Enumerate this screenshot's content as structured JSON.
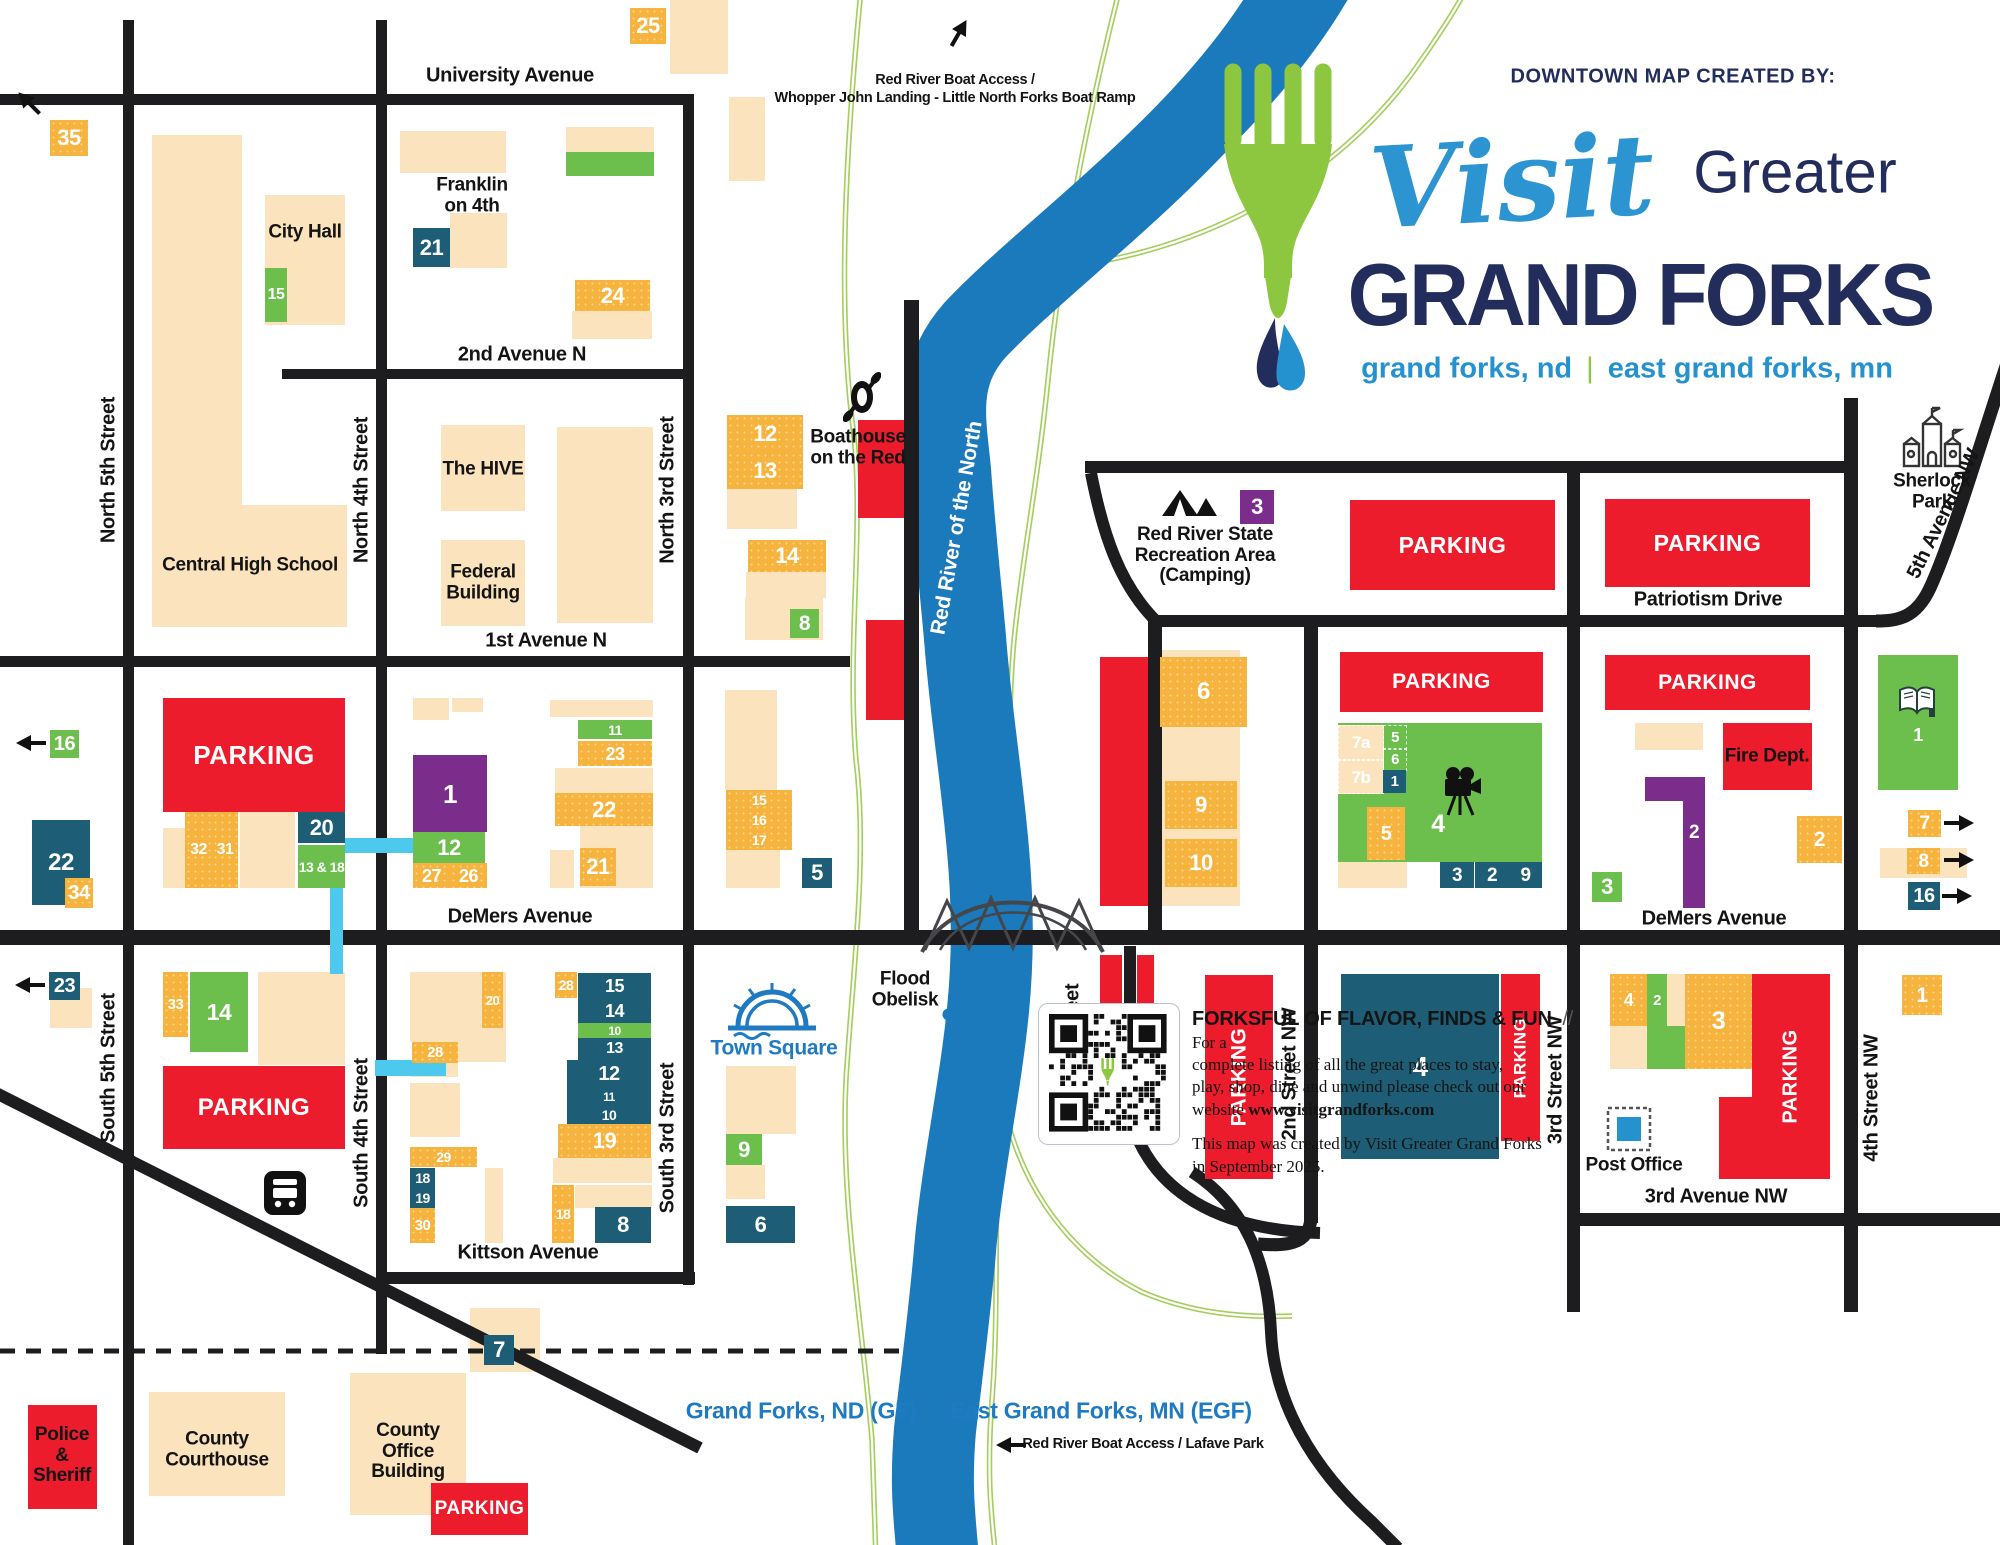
{
  "map": {
    "colors": {
      "river": "#1b7abc",
      "road": "#1d1d1f",
      "parking_red": "#ec1c2d",
      "orange": "#f6b33d",
      "green": "#6cbf4c",
      "teal": "#1d5d75",
      "purple": "#7b2d8b",
      "building": "#fbe4bd",
      "trail": "#a6ce5e",
      "skywalk": "#4ec9ee",
      "navy": "#232d5c",
      "blue": "#2492cf",
      "lime": "#8dc63f"
    },
    "logo": {
      "created_by": "DOWNTOWN MAP CREATED BY:",
      "visit": "Visit",
      "greater": "Greater",
      "grand_forks": "GRAND FORKS",
      "sub_left": "grand forks, nd",
      "sub_divider": "|",
      "sub_right": "east grand forks, mn"
    },
    "credits": {
      "heading": "FORKSFUL OF  FLAVOR, FINDS & FUN",
      "separator": "//",
      "lead": "For a",
      "body1": "complete listing of all the great places to stay,",
      "body2": "play, shop, dine and unwind please check out our",
      "body3_pre": "website ",
      "body3_bold": "www.visitgrandforks.com",
      "note1": "This map was created by Visit Greater Grand Forks",
      "note2": "in September 2025."
    },
    "parking_label": "PARKING",
    "city_labels": [
      {
        "t": "Grand Forks, ND (GF)",
        "x": 801,
        "y": 1411
      },
      {
        "t": "East Grand Forks, MN (EGF)",
        "x": 1101,
        "y": 1411
      }
    ],
    "annotations": [
      {
        "t": "Red River Boat Access /\nWhopper John Landing - Little North Forks Boat Ramp",
        "x": 955,
        "y": 89
      },
      {
        "t": "Red River Boat Access / Lafave Park",
        "x": 1143,
        "y": 1444
      }
    ],
    "streets": [
      {
        "t": "University Avenue",
        "x": 510,
        "y": 76,
        "r": 0
      },
      {
        "t": "2nd Avenue N",
        "x": 522,
        "y": 355,
        "r": 0
      },
      {
        "t": "1st Avenue N",
        "x": 546,
        "y": 641,
        "r": 0
      },
      {
        "t": "DeMers Avenue",
        "x": 520,
        "y": 917,
        "r": 0
      },
      {
        "t": "Kittson Avenue",
        "x": 528,
        "y": 1253,
        "r": 0
      },
      {
        "t": "DeMers Avenue",
        "x": 1714,
        "y": 919,
        "r": 0
      },
      {
        "t": "Patriotism Drive",
        "x": 1708,
        "y": 600,
        "r": 0
      },
      {
        "t": "3rd Avenue NW",
        "x": 1716,
        "y": 1197,
        "r": 0
      },
      {
        "t": "North 5th Street",
        "x": 109,
        "y": 470,
        "r": -90
      },
      {
        "t": "South 5th Street",
        "x": 109,
        "y": 1068,
        "r": -90
      },
      {
        "t": "North 4th Street",
        "x": 362,
        "y": 490,
        "r": -90
      },
      {
        "t": "South 4th Street",
        "x": 362,
        "y": 1133,
        "r": -90
      },
      {
        "t": "North 3rd Street",
        "x": 668,
        "y": 490,
        "r": -90
      },
      {
        "t": "South 3rd Street",
        "x": 668,
        "y": 1138,
        "r": -90
      },
      {
        "t": "River Street",
        "x": 1073,
        "y": 1038,
        "r": -90
      },
      {
        "t": "2nd Street NW",
        "x": 1290,
        "y": 1074,
        "r": -90
      },
      {
        "t": "3rd Street NW",
        "x": 1556,
        "y": 1080,
        "r": -90
      },
      {
        "t": "4th Street NW",
        "x": 1872,
        "y": 1098,
        "r": -90
      },
      {
        "t": "5th Avenue NW",
        "x": 1944,
        "y": 514,
        "r": -64
      },
      {
        "t": "Red River of the North",
        "x": 957,
        "y": 528,
        "r": -80,
        "river": true
      }
    ],
    "landmarks": [
      {
        "t": "City Hall",
        "x": 305,
        "y": 233
      },
      {
        "t": "Franklin\non 4th",
        "x": 472,
        "y": 196
      },
      {
        "t": "Central High School",
        "x": 250,
        "y": 566
      },
      {
        "t": "The HIVE",
        "x": 483,
        "y": 470
      },
      {
        "t": "Federal\nBuilding",
        "x": 483,
        "y": 583
      },
      {
        "t": "Boathouse\non the Red",
        "x": 858,
        "y": 448
      },
      {
        "t": "Red River State\nRecreation Area\n(Camping)",
        "x": 1205,
        "y": 556
      },
      {
        "t": "Sherlock\nPark",
        "x": 1932,
        "y": 492
      },
      {
        "t": "Fire Dept.",
        "x": 1767,
        "y": 757
      },
      {
        "t": "Town Square",
        "x": 774,
        "y": 1049,
        "cls": "blue"
      },
      {
        "t": "Flood\nObelisk",
        "x": 905,
        "y": 990
      },
      {
        "t": "Post Office",
        "x": 1634,
        "y": 1166
      },
      {
        "t": "County\nCourthouse",
        "x": 217,
        "y": 1450
      },
      {
        "t": "County\nOffice\nBuilding",
        "x": 408,
        "y": 1452
      },
      {
        "t": "Police\n&\nSheriff",
        "x": 62,
        "y": 1456
      }
    ],
    "parking_lots": [
      {
        "x": 163,
        "y": 698,
        "w": 182,
        "h": 114,
        "v": false,
        "fs": 26
      },
      {
        "x": 163,
        "y": 1066,
        "w": 182,
        "h": 83,
        "v": false,
        "fs": 24
      },
      {
        "x": 1350,
        "y": 500,
        "w": 205,
        "h": 90,
        "v": false,
        "fs": 23
      },
      {
        "x": 1605,
        "y": 499,
        "w": 205,
        "h": 88,
        "v": false,
        "fs": 23
      },
      {
        "x": 1340,
        "y": 652,
        "w": 203,
        "h": 60,
        "v": false,
        "fs": 21
      },
      {
        "x": 1605,
        "y": 655,
        "w": 205,
        "h": 55,
        "v": false,
        "fs": 21
      },
      {
        "x": 1205,
        "y": 975,
        "w": 68,
        "h": 204,
        "v": true,
        "fs": 21
      },
      {
        "x": 1501,
        "y": 974,
        "w": 39,
        "h": 167,
        "v": true,
        "fs": 17
      },
      {
        "x": 1752,
        "y": 974,
        "w": 78,
        "h": 205,
        "v": true,
        "fs": 20
      },
      {
        "x": 431,
        "y": 1483,
        "w": 97,
        "h": 52,
        "v": false,
        "fs": 19
      }
    ],
    "markers": [
      {
        "n": "25",
        "c": "o",
        "x": 630,
        "y": 8,
        "w": 36,
        "h": 36
      },
      {
        "n": "35",
        "c": "o",
        "x": 50,
        "y": 120,
        "w": 38,
        "h": 36
      },
      {
        "n": "15",
        "c": "g",
        "x": 265,
        "y": 268,
        "w": 22,
        "h": 54
      },
      {
        "n": "21",
        "c": "t",
        "x": 413,
        "y": 228,
        "w": 37,
        "h": 39
      },
      {
        "n": "24",
        "c": "o",
        "x": 575,
        "y": 280,
        "w": 75,
        "h": 31
      },
      {
        "n": "12",
        "c": "o",
        "x": 727,
        "y": 415,
        "w": 76,
        "h": 37
      },
      {
        "n": "13",
        "c": "o",
        "x": 727,
        "y": 452,
        "w": 76,
        "h": 37
      },
      {
        "n": "14",
        "c": "o",
        "x": 748,
        "y": 540,
        "w": 78,
        "h": 32
      },
      {
        "n": "8",
        "c": "g",
        "x": 790,
        "y": 609,
        "w": 29,
        "h": 29
      },
      {
        "n": "16",
        "c": "g",
        "x": 50,
        "y": 730,
        "w": 29,
        "h": 28
      },
      {
        "n": "22",
        "c": "t",
        "x": 32,
        "y": 820,
        "w": 58,
        "h": 85,
        "fs": 24
      },
      {
        "n": "34",
        "c": "o",
        "x": 65,
        "y": 878,
        "w": 28,
        "h": 30
      },
      {
        "n": "32",
        "c": "o",
        "x": 185,
        "y": 812,
        "w": 27,
        "h": 76,
        "fs": 16
      },
      {
        "n": "31",
        "c": "o",
        "x": 212,
        "y": 812,
        "w": 26,
        "h": 76,
        "fs": 16
      },
      {
        "n": "20",
        "c": "t",
        "x": 298,
        "y": 812,
        "w": 47,
        "h": 31
      },
      {
        "n": "13 & 18",
        "c": "g",
        "x": 298,
        "y": 845,
        "w": 47,
        "h": 43,
        "fs": 14
      },
      {
        "n": "1",
        "c": "p",
        "x": 413,
        "y": 755,
        "w": 74,
        "h": 77,
        "fs": 26
      },
      {
        "n": "12",
        "c": "g",
        "x": 413,
        "y": 832,
        "w": 72,
        "h": 31
      },
      {
        "n": "27",
        "c": "o",
        "x": 413,
        "y": 863,
        "w": 37,
        "h": 25
      },
      {
        "n": "26",
        "c": "o",
        "x": 450,
        "y": 863,
        "w": 37,
        "h": 25
      },
      {
        "n": "11",
        "c": "g",
        "x": 578,
        "y": 720,
        "w": 74,
        "h": 19
      },
      {
        "n": "23",
        "c": "o",
        "x": 578,
        "y": 741,
        "w": 74,
        "h": 25
      },
      {
        "n": "22",
        "c": "o",
        "x": 555,
        "y": 793,
        "w": 98,
        "h": 33
      },
      {
        "n": "21",
        "c": "o",
        "x": 580,
        "y": 848,
        "w": 36,
        "h": 38
      },
      {
        "n": "15",
        "c": "o",
        "x": 726,
        "y": 790,
        "w": 66,
        "h": 20
      },
      {
        "n": "16",
        "c": "o",
        "x": 726,
        "y": 810,
        "w": 66,
        "h": 20
      },
      {
        "n": "17",
        "c": "o",
        "x": 726,
        "y": 830,
        "w": 66,
        "h": 20
      },
      {
        "n": "5",
        "c": "t",
        "x": 802,
        "y": 858,
        "w": 30,
        "h": 30
      },
      {
        "n": "23",
        "c": "t",
        "x": 49,
        "y": 972,
        "w": 31,
        "h": 28
      },
      {
        "n": "33",
        "c": "o",
        "x": 163,
        "y": 972,
        "w": 25,
        "h": 65,
        "fs": 15
      },
      {
        "n": "14",
        "c": "g",
        "x": 190,
        "y": 972,
        "w": 58,
        "h": 80,
        "fs": 23
      },
      {
        "n": "20",
        "c": "o",
        "x": 482,
        "y": 972,
        "w": 21,
        "h": 56,
        "fs": 13
      },
      {
        "n": "28",
        "c": "o",
        "x": 412,
        "y": 1042,
        "w": 46,
        "h": 21
      },
      {
        "n": "29",
        "c": "o",
        "x": 410,
        "y": 1147,
        "w": 67,
        "h": 20
      },
      {
        "n": "18",
        "c": "t",
        "x": 410,
        "y": 1168,
        "w": 25,
        "h": 20
      },
      {
        "n": "19",
        "c": "t",
        "x": 410,
        "y": 1188,
        "w": 25,
        "h": 20
      },
      {
        "n": "30",
        "c": "o",
        "x": 410,
        "y": 1208,
        "w": 25,
        "h": 35,
        "fs": 15
      },
      {
        "n": "28",
        "c": "o",
        "x": 555,
        "y": 972,
        "w": 22,
        "h": 26,
        "fs": 14
      },
      {
        "n": "15",
        "c": "t",
        "x": 578,
        "y": 973,
        "w": 73,
        "h": 25
      },
      {
        "n": "14",
        "c": "t",
        "x": 578,
        "y": 998,
        "w": 73,
        "h": 25
      },
      {
        "n": "10",
        "c": "g",
        "x": 578,
        "y": 1023,
        "w": 73,
        "h": 15
      },
      {
        "n": "13",
        "c": "t",
        "x": 578,
        "y": 1038,
        "w": 73,
        "h": 22
      },
      {
        "n": "12",
        "c": "t",
        "x": 567,
        "y": 1060,
        "w": 84,
        "h": 28
      },
      {
        "n": "11",
        "c": "t",
        "x": 567,
        "y": 1088,
        "w": 84,
        "h": 17
      },
      {
        "n": "10",
        "c": "t",
        "x": 567,
        "y": 1105,
        "w": 84,
        "h": 19
      },
      {
        "n": "19",
        "c": "o",
        "x": 558,
        "y": 1124,
        "w": 93,
        "h": 34
      },
      {
        "n": "18",
        "c": "o",
        "x": 552,
        "y": 1185,
        "w": 22,
        "h": 58,
        "fs": 14
      },
      {
        "n": "8",
        "c": "t",
        "x": 595,
        "y": 1207,
        "w": 56,
        "h": 36
      },
      {
        "n": "9",
        "c": "g",
        "x": 726,
        "y": 1134,
        "w": 36,
        "h": 31
      },
      {
        "n": "6",
        "c": "t",
        "x": 726,
        "y": 1206,
        "w": 69,
        "h": 37
      },
      {
        "n": "7",
        "c": "t",
        "x": 484,
        "y": 1335,
        "w": 30,
        "h": 30
      },
      {
        "n": "3",
        "c": "p",
        "x": 1240,
        "y": 490,
        "w": 34,
        "h": 34
      },
      {
        "n": "6",
        "c": "o",
        "x": 1160,
        "y": 657,
        "w": 87,
        "h": 70,
        "fs": 24
      },
      {
        "n": "9",
        "c": "o",
        "x": 1165,
        "y": 781,
        "w": 72,
        "h": 48,
        "fs": 22
      },
      {
        "n": "10",
        "c": "o",
        "x": 1165,
        "y": 839,
        "w": 72,
        "h": 48,
        "fs": 22
      },
      {
        "n": "7a",
        "c": "cr",
        "x": 1338,
        "y": 725,
        "w": 44,
        "h": 33,
        "fs": 17
      },
      {
        "n": "7b",
        "c": "cr",
        "x": 1338,
        "y": 760,
        "w": 44,
        "h": 32,
        "fs": 17
      },
      {
        "n": "5",
        "c": "ghost",
        "x": 1383,
        "y": 725,
        "w": 22,
        "h": 23,
        "fs": 15
      },
      {
        "n": "6",
        "c": "ghost",
        "x": 1383,
        "y": 748,
        "w": 22,
        "h": 21,
        "fs": 15
      },
      {
        "n": "1",
        "c": "t",
        "x": 1383,
        "y": 770,
        "w": 23,
        "h": 23,
        "fs": 15
      },
      {
        "n": "5",
        "c": "o",
        "x": 1367,
        "y": 807,
        "w": 38,
        "h": 53,
        "fs": 20
      },
      {
        "n": "4",
        "c": "plain",
        "x": 1425,
        "y": 810,
        "w": 26,
        "h": 28,
        "fs": 25
      },
      {
        "n": "3",
        "c": "t",
        "x": 1440,
        "y": 862,
        "w": 34,
        "h": 26
      },
      {
        "n": "2",
        "c": "t",
        "x": 1475,
        "y": 862,
        "w": 34,
        "h": 26
      },
      {
        "n": "9",
        "c": "t",
        "x": 1509,
        "y": 862,
        "w": 33,
        "h": 26
      },
      {
        "n": "2",
        "c": "plain",
        "x": 1683,
        "y": 820,
        "w": 22,
        "h": 24,
        "fs": 19
      },
      {
        "n": "3",
        "c": "g",
        "x": 1592,
        "y": 872,
        "w": 30,
        "h": 30
      },
      {
        "n": "2",
        "c": "o",
        "x": 1797,
        "y": 816,
        "w": 45,
        "h": 47,
        "fs": 21
      },
      {
        "n": "4",
        "c": "o",
        "x": 1610,
        "y": 974,
        "w": 37,
        "h": 52,
        "fs": 18
      },
      {
        "n": "2",
        "c": "g",
        "x": 1647,
        "y": 974,
        "w": 20,
        "h": 52,
        "fs": 15
      },
      {
        "n": "3",
        "c": "o",
        "x": 1685,
        "y": 974,
        "w": 67,
        "h": 95,
        "fs": 25
      },
      {
        "n": "4",
        "c": "t",
        "x": 1341,
        "y": 974,
        "w": 158,
        "h": 185,
        "fs": 28
      },
      {
        "n": "1",
        "c": "o",
        "x": 1902,
        "y": 975,
        "w": 40,
        "h": 40,
        "fs": 21
      },
      {
        "n": "7",
        "c": "o",
        "x": 1908,
        "y": 810,
        "w": 33,
        "h": 27
      },
      {
        "n": "8",
        "c": "o",
        "x": 1907,
        "y": 848,
        "w": 33,
        "h": 26
      },
      {
        "n": "16",
        "c": "t",
        "x": 1908,
        "y": 882,
        "w": 32,
        "h": 28
      },
      {
        "n": "1",
        "c": "plain",
        "x": 1908,
        "y": 723,
        "w": 20,
        "h": 24,
        "fs": 18
      }
    ],
    "icons": [
      {
        "i": "kayak",
        "x": 843,
        "y": 368,
        "w": 38,
        "h": 58
      },
      {
        "i": "tent",
        "x": 1160,
        "y": 486,
        "w": 58,
        "h": 32
      },
      {
        "i": "camera",
        "x": 1443,
        "y": 765,
        "w": 40,
        "h": 52
      },
      {
        "i": "book",
        "x": 1896,
        "y": 684,
        "w": 42,
        "h": 34
      },
      {
        "i": "castle",
        "x": 1898,
        "y": 406,
        "w": 68,
        "h": 64
      },
      {
        "i": "stamp",
        "x": 1606,
        "y": 1106,
        "w": 46,
        "h": 46
      },
      {
        "i": "townsquare",
        "x": 724,
        "y": 968,
        "w": 96,
        "h": 74
      },
      {
        "i": "dot",
        "x": 942,
        "y": 1008,
        "w": 13,
        "h": 13
      },
      {
        "i": "bus",
        "x": 264,
        "y": 1171,
        "w": 42,
        "h": 44
      },
      {
        "i": "arrow",
        "x": 14,
        "y": 94,
        "w": 30,
        "h": 18,
        "r": -135
      },
      {
        "i": "arrow",
        "x": 16,
        "y": 734,
        "w": 30,
        "h": 18,
        "r": 180
      },
      {
        "i": "arrow",
        "x": 15,
        "y": 976,
        "w": 30,
        "h": 18,
        "r": 180
      },
      {
        "i": "arrow",
        "x": 1944,
        "y": 814,
        "w": 30,
        "h": 18,
        "r": 0
      },
      {
        "i": "arrow",
        "x": 1944,
        "y": 851,
        "w": 30,
        "h": 18,
        "r": 0
      },
      {
        "i": "arrow",
        "x": 1942,
        "y": 887,
        "w": 30,
        "h": 18,
        "r": 0
      },
      {
        "i": "arrow",
        "x": 944,
        "y": 24,
        "w": 30,
        "h": 18,
        "r": -60
      },
      {
        "i": "arrow",
        "x": 996,
        "y": 1436,
        "w": 30,
        "h": 18,
        "r": 180
      }
    ]
  }
}
